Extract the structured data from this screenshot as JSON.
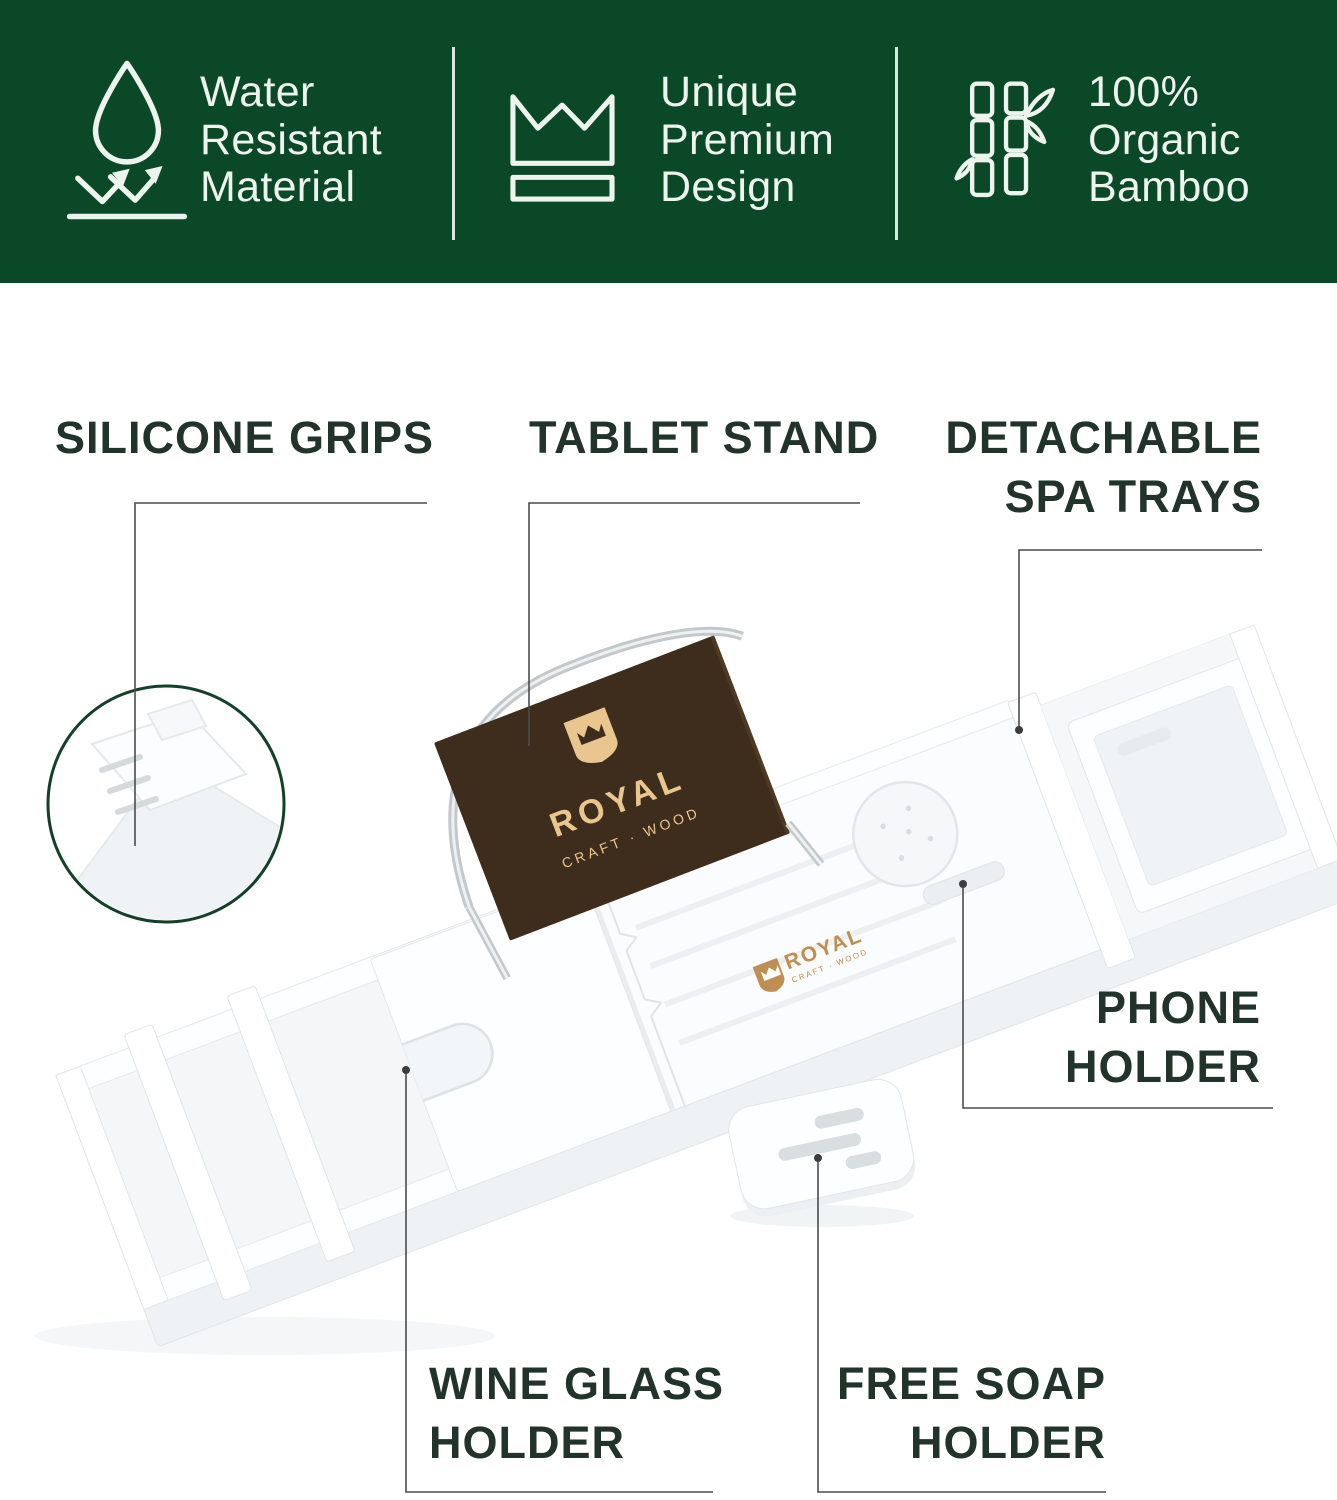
{
  "banner": {
    "background_color": "#0a4828",
    "text_color": "#edf3ed",
    "features": [
      {
        "icon": "water-drop-icon",
        "line1": "Water",
        "line2": "Resistant",
        "line3": "Material"
      },
      {
        "icon": "crown-icon",
        "line1": "Unique",
        "line2": "Premium",
        "line3": "Design"
      },
      {
        "icon": "bamboo-icon",
        "line1": "100%",
        "line2": "Organic",
        "line3": "Bamboo"
      }
    ]
  },
  "callouts": {
    "silicone_grips": {
      "line1": "SILICONE GRIPS"
    },
    "tablet_stand": {
      "line1": "TABLET STAND"
    },
    "detachable_spa_trays": {
      "line1": "DETACHABLE",
      "line2": "SPA TRAYS"
    },
    "phone_holder": {
      "line1": "PHONE",
      "line2": "HOLDER"
    },
    "wine_glass_holder": {
      "line1": "WINE GLASS",
      "line2": "HOLDER"
    },
    "free_soap_holder": {
      "line1": "FREE SOAP",
      "line2": "HOLDER"
    }
  },
  "product": {
    "board_logo": {
      "brand": "ROYAL",
      "tagline": "CRAFT · WOOD"
    },
    "deck_logo": {
      "brand": "ROYAL",
      "tagline": "CRAFT · WOOD"
    },
    "colors": {
      "board_brown": "#3e2c1c",
      "logo_gold": "#e9c68f",
      "deck_logo_gold": "#bf8e51",
      "label_text": "#22332c",
      "callout_line": "#4c4c4c",
      "magnifier_ring": "#153f2a"
    }
  }
}
